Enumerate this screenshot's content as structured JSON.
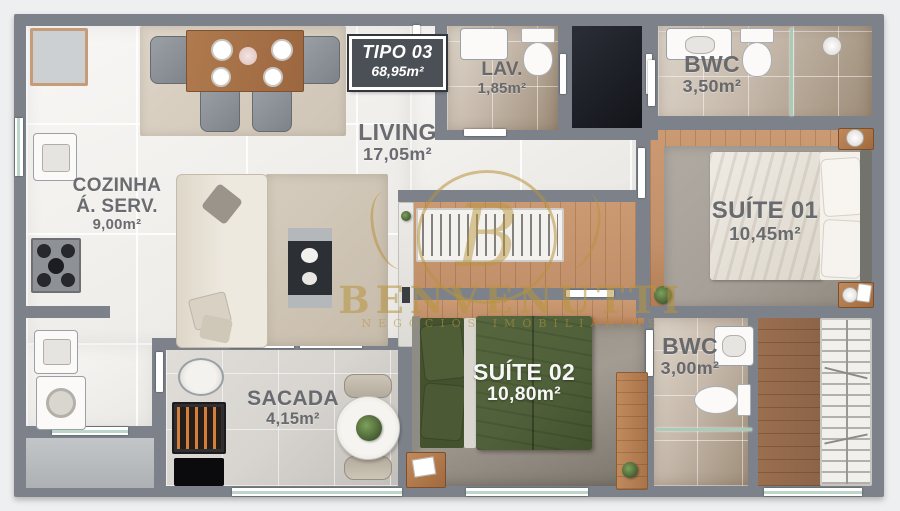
{
  "unit_box": {
    "title": "TIPO 03",
    "area": "68,95m²"
  },
  "rooms": {
    "living": {
      "name": "LIVING",
      "area": "17,05m²"
    },
    "cozinha": {
      "name": "COZINHA",
      "name2": "Á. SERV.",
      "area": "9,00m²"
    },
    "lav": {
      "name": "LAV.",
      "area": "1,85m²"
    },
    "bwc1": {
      "name": "BWC",
      "area": "3,50m²"
    },
    "suite1": {
      "name": "SUÍTE 01",
      "area": "10,45m²"
    },
    "bwc2": {
      "name": "BWC",
      "area": "3,00m²"
    },
    "suite2": {
      "name": "SUÍTE 02",
      "area": "10,80m²"
    },
    "sacada": {
      "name": "SACADA",
      "area": "4,15m²"
    }
  },
  "watermark": {
    "monogram": "B",
    "name": "BENVENUTTI",
    "tagline": "NEGÓCIOS IMOBILIÁRIOS"
  },
  "colors": {
    "wall": "#7d828a",
    "tile": "#f3f1ee",
    "wood": "#c2906a",
    "wood_dark": "#8d6448",
    "bed_green": "#50603a",
    "rug": "#a6a098",
    "label": "#63666b",
    "unit_box": "#4b4f56",
    "gold": "#b8943e",
    "bath": "#c6b9ab",
    "sacada": "#d8d5d0"
  }
}
